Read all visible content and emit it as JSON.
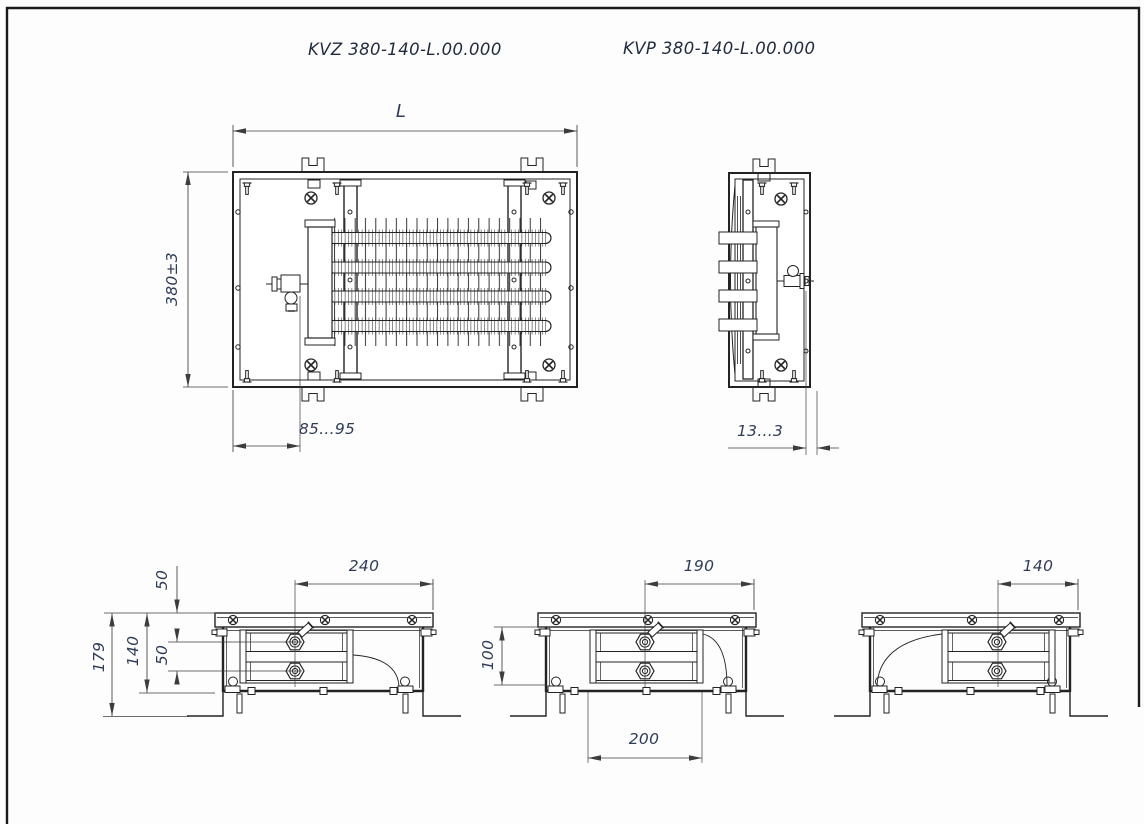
{
  "drawing": {
    "title_left": "KVZ 380-140-L.00.000",
    "title_right": "KVP 380-140-L.00.000",
    "dims": {
      "plan_length": "L",
      "plan_height": "380±3",
      "plan_valve_offset": "85...95",
      "side_valve_offset": "13...3",
      "sec_a_top_width": "240",
      "sec_a_recess_depth": "50",
      "sec_a_tube_spacing": "50",
      "sec_a_body_height": "140",
      "sec_a_total_height": "179",
      "sec_b_top_width": "190",
      "sec_b_body_height": "100",
      "sec_b_coil_width": "200",
      "sec_c_top_width": "140"
    },
    "colors": {
      "line": "#232323",
      "dim": "#3c3c3c",
      "text": "#2e3c58"
    }
  }
}
